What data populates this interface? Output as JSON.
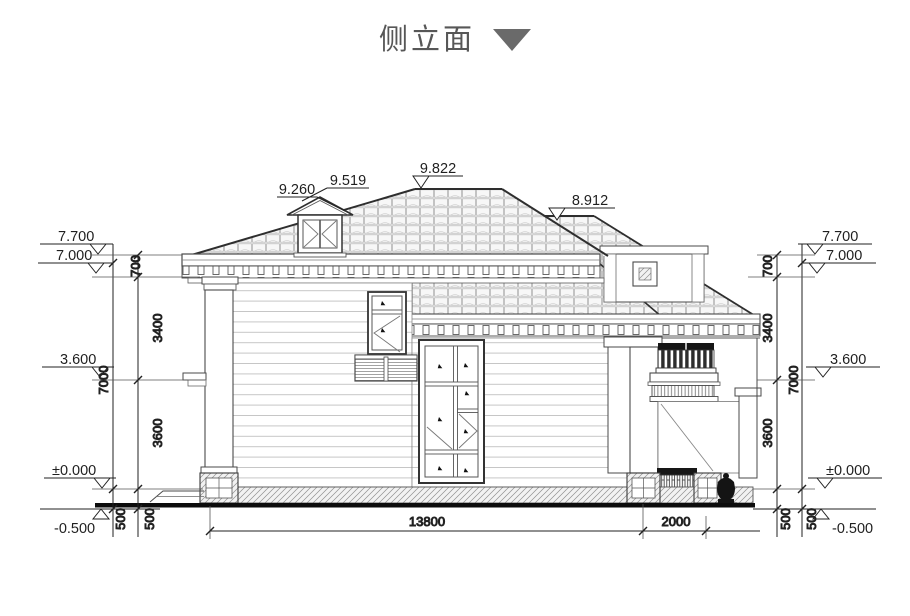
{
  "title": {
    "label": "侧立面"
  },
  "roof_markers": {
    "dormer_peak": "9.260",
    "dormer_ridge": "9.519",
    "main_ridge": "9.822",
    "secondary_ridge": "8.912"
  },
  "levels": {
    "eave_top": "7.700",
    "eave_bottom": "7.000",
    "second_floor": "3.600",
    "ground_floor": "±0.000",
    "grade": "-0.500"
  },
  "vertical_dims": {
    "eave_band": "700",
    "upper_storey": "3400",
    "lower_storey": "3600",
    "plinth": "500",
    "total": "7000"
  },
  "horizontal_dims": {
    "main_width": "13800",
    "porch_width": "2000"
  },
  "colors": {
    "line": "#3a3a3a",
    "title_text": "#575757",
    "title_triangle": "#6a6a6a"
  }
}
